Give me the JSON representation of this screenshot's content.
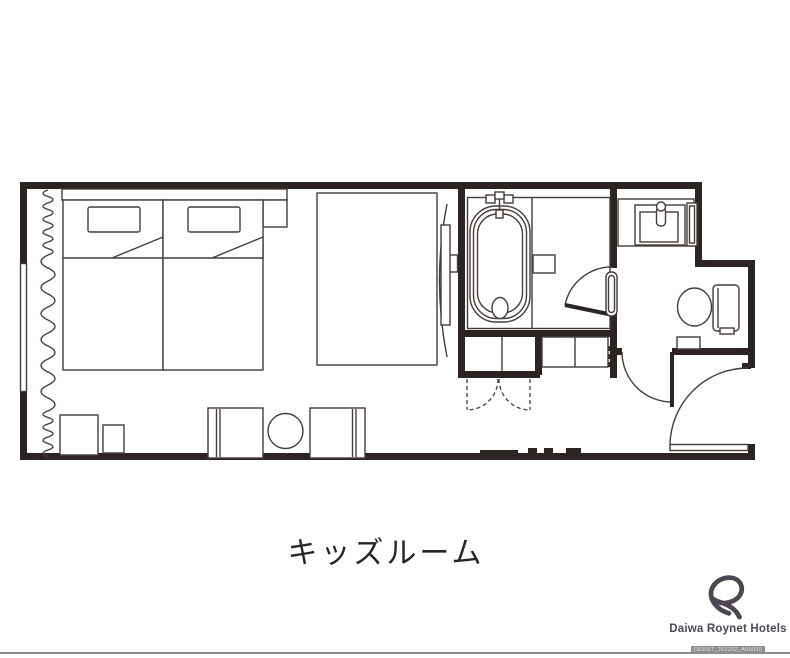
{
  "title": "キッズルーム",
  "brand": {
    "logo_text": "Daiwa Roynet Hotels",
    "code": "DRHST_202202_A00030"
  },
  "colors": {
    "ink": "#2b2422",
    "line": "#453d39",
    "brand": "#4d4751",
    "code_bg": "#8f8f8f",
    "rule": "#8d8d8d",
    "title_ink": "#2a2523",
    "bg": "#ffffff"
  }
}
